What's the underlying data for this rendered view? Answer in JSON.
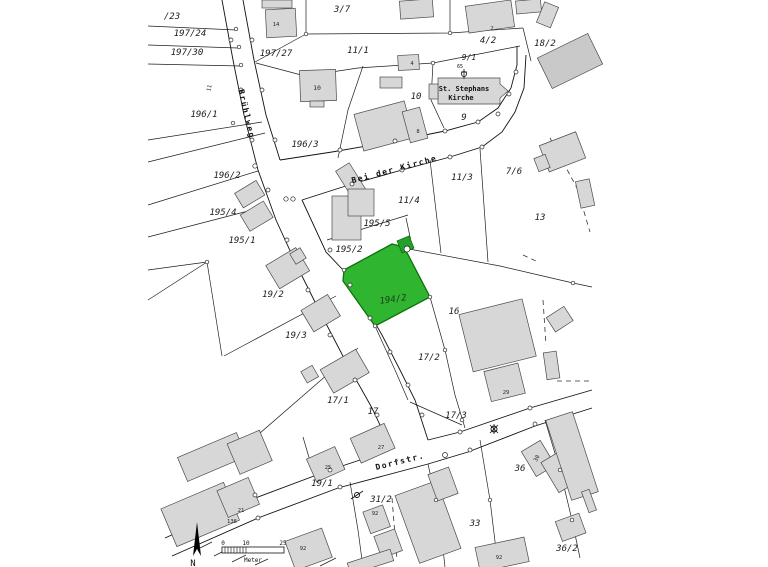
{
  "colors": {
    "highlight": "#2fb52f",
    "highlight_border": "#0c720c",
    "highlight_building": "#23a02c",
    "building": "#d7d7d7",
    "building_dark": "#c9c9c9",
    "line": "#1f1f1f"
  },
  "parcels": {
    "p23": "/23",
    "p197_24": "197/24",
    "p197_30": "197/30",
    "p196_1": "196/1",
    "p197_27": "197/27",
    "p3_7": "3/7",
    "p11_1": "11/1",
    "p4_2": "4/2",
    "p9_1": "9/1",
    "p18_2": "18/2",
    "p10": "10",
    "p9": "9",
    "p196_3": "196/3",
    "p196_2": "196/2",
    "p11_3": "11/3",
    "p7_6": "7/6",
    "p11_4": "11/4",
    "p13": "13",
    "p195_4": "195/4",
    "p195_5": "195/5",
    "p195_1": "195/1",
    "p195_2": "195/2",
    "p194_2": "194/2",
    "p16": "16",
    "p19_2": "19/2",
    "p19_3": "19/3",
    "p17_2": "17/2",
    "p17_1": "17/1",
    "p17": "17",
    "p17_3": "17/3",
    "p19_1": "19/1",
    "p31_2": "31/2",
    "p33": "33",
    "p36": "36",
    "p36_2": "36/2"
  },
  "streets": {
    "bruehlweg": "Brühlweg",
    "bei_der_kirche": "Bei der Kirche",
    "dorfstr": "Dorfstr."
  },
  "church": {
    "name_line1": "St. Stephans",
    "name_line2": "Kirche",
    "point_number": "65"
  },
  "house_numbers": {
    "h14": "14",
    "h2": "2",
    "h4": "4",
    "h10": "10",
    "h8": "8",
    "h11": "11",
    "h29": "29",
    "h27": "27",
    "h25": "25",
    "h21": "21",
    "h136": "136",
    "h92a": "92",
    "h92b": "92",
    "h92c": "92",
    "h30": "30"
  },
  "scale_bar": {
    "tick_0": "0",
    "tick_10": "10",
    "tick_25": "25",
    "unit": "Meter"
  },
  "north_arrow": {
    "label": "N"
  }
}
